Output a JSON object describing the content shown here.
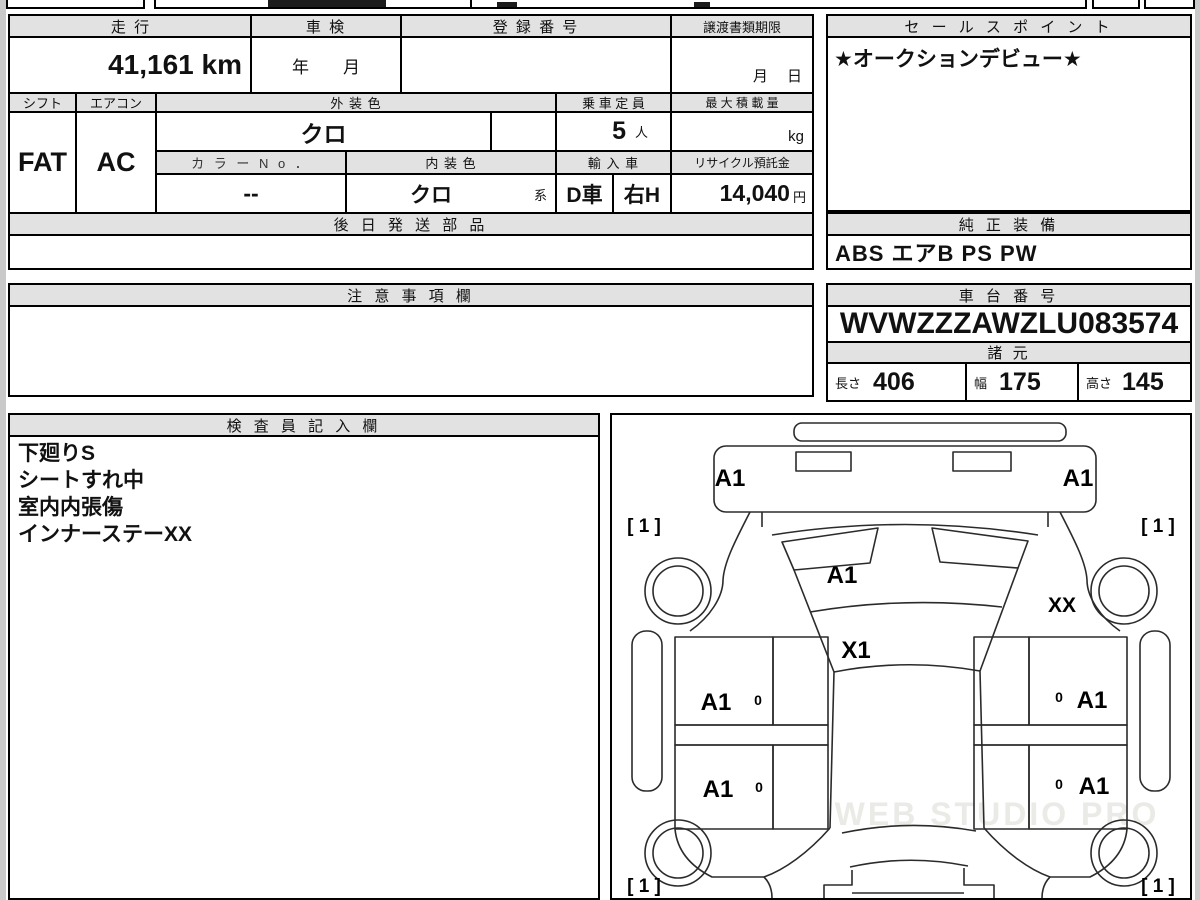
{
  "sheet": {
    "top": {
      "mileage_label": "走 行",
      "mileage_value": "41,161 km",
      "shaken_label": "車 検",
      "shaken_value": "年　　月",
      "registration_label": "登 録 番 号",
      "registration_value": "",
      "transfer_label": "譲渡書類期限",
      "transfer_value": "月　 日",
      "sales_label": "セ ー ル ス ポ イ ン ト",
      "sales_value": "★オークションデビュー★"
    },
    "spec": {
      "shift_label": "シフト",
      "shift_value": "FAT",
      "aircon_label": "エアコン",
      "aircon_value": "AC",
      "exterior_label": "外 装 色",
      "exterior_value": "クロ",
      "capacity_label": "乗 車 定 員",
      "capacity_value": "5",
      "capacity_unit": "人",
      "load_label": "最 大 積 載 量",
      "load_unit": "kg",
      "colorno_label": "カ ラ ー N o ．",
      "colorno_value": "--",
      "interior_label": "内 装 色",
      "interior_value": "クロ",
      "interior_suffix": "系",
      "import_label": "輸 入 車",
      "import_value_1": "D車",
      "import_value_2": "右H",
      "recycle_label": "リサイクル預託金",
      "recycle_value": "14,040",
      "recycle_unit": "円"
    },
    "later_parts_label": "後 日 発 送 部 品",
    "later_parts_value": "",
    "equipment_label": "純 正 装 備",
    "equipment_value": "ABS エアB PS PW",
    "notes_label": "注 意 事 項 欄",
    "notes_value": "",
    "chassis_label": "車 台 番 号",
    "chassis_value": "WVWZZZAWZLU083574",
    "dimensions_label": "諸 元",
    "dim_length_label": "長さ",
    "dim_length_value": "406",
    "dim_width_label": "幅",
    "dim_width_value": "175",
    "dim_height_label": "高さ",
    "dim_height_value": "145",
    "inspector_label": "検 査 員 記 入 欄",
    "inspector_lines": [
      "下廻りS",
      "シートすれ中",
      "室内内張傷",
      "インナーステーXX"
    ]
  },
  "diagram": {
    "bumper_front_left": "A1",
    "bumper_front_right": "A1",
    "tire_front_left": "[ 1 ]",
    "tire_front_right": "[ 1 ]",
    "hood": "A1",
    "fender_right": "XX",
    "windshield": "X1",
    "door_front_left": "A1",
    "door_front_right": "A1",
    "door_rear_left": "A1",
    "door_rear_right": "A1",
    "handle_mark": "0",
    "tire_rear_left": "[ 1 ]",
    "tire_rear_right": "[ 1 ]",
    "watermark": "WEB STUDIO PRO"
  }
}
